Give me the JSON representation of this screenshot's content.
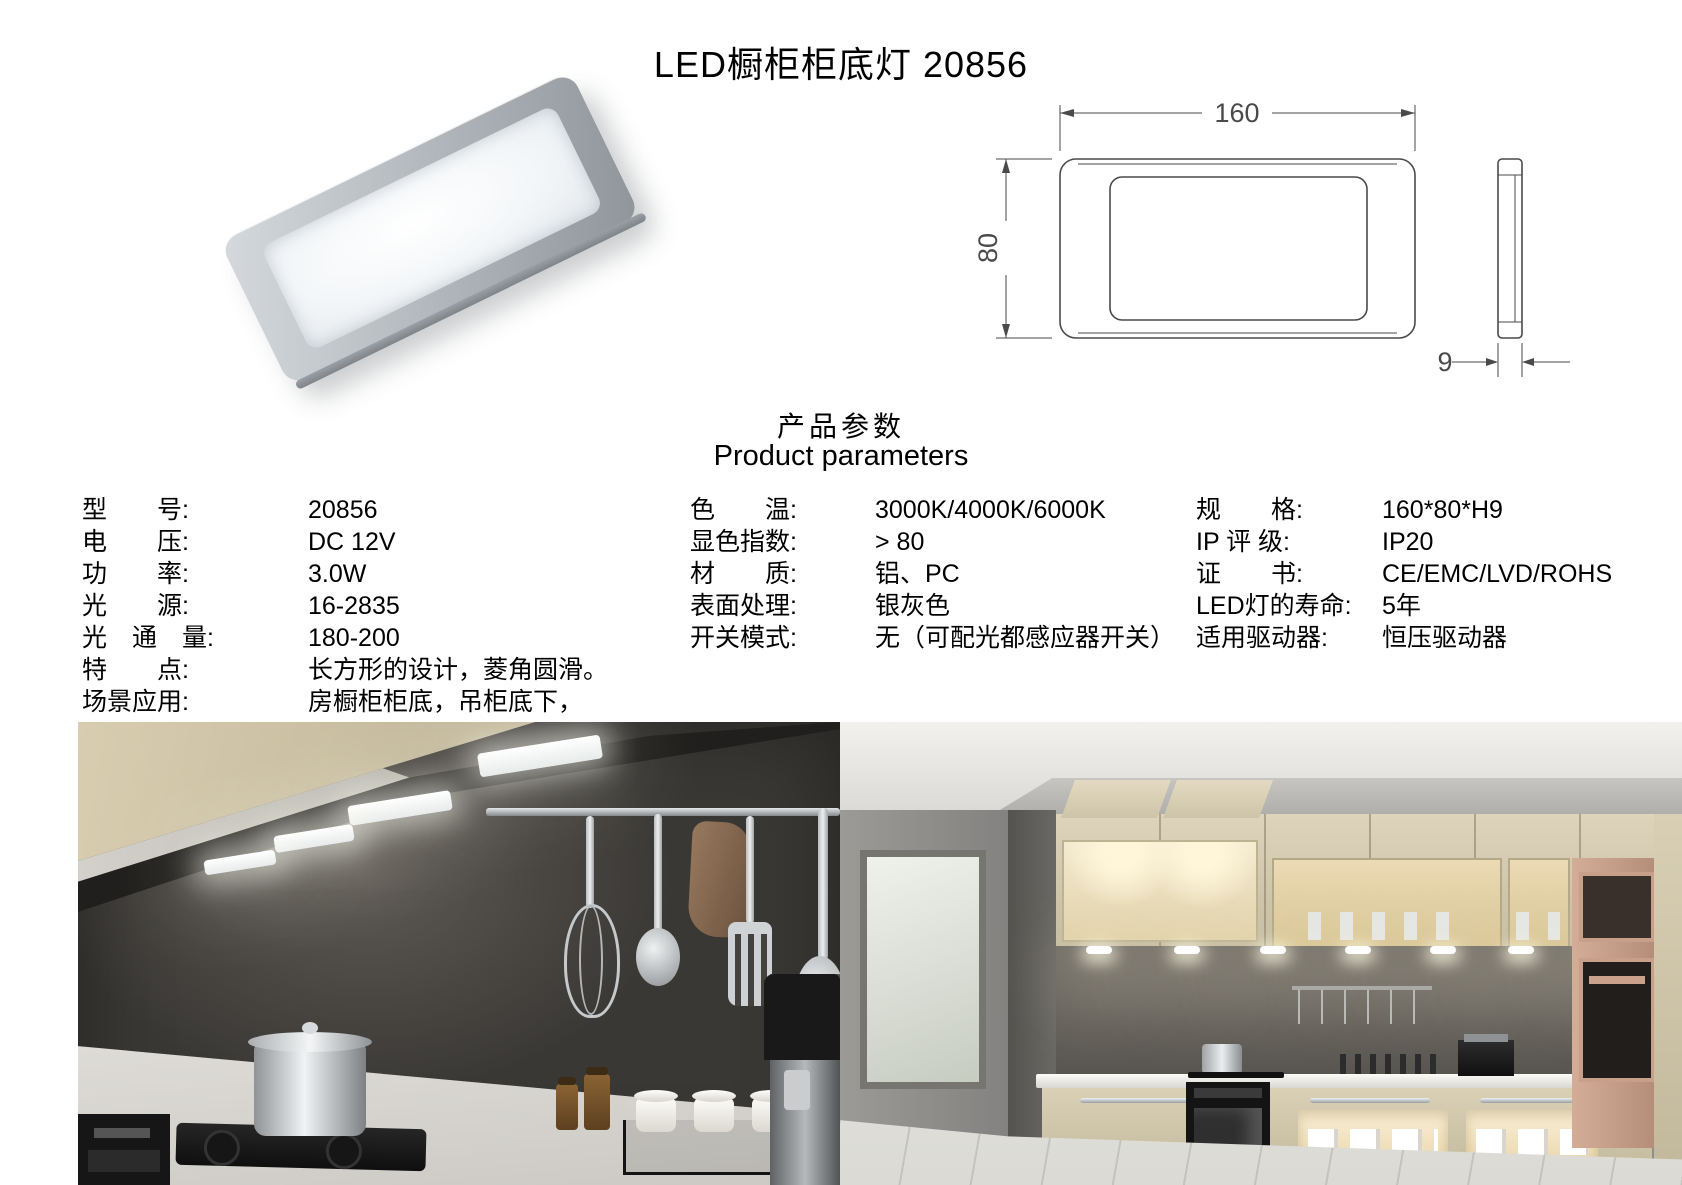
{
  "title": "LED橱柜柜底灯 20856",
  "headings": {
    "zh": "产品参数",
    "en": "Product parameters"
  },
  "drawing": {
    "width": "160",
    "height": "80",
    "thickness": "9"
  },
  "specs": {
    "col1": [
      {
        "label": "型　　号:",
        "value": "20856"
      },
      {
        "label": "电　　压:",
        "value": "DC 12V"
      },
      {
        "label": "功　　率:",
        "value": "3.0W"
      },
      {
        "label": "光　　源:",
        "value": "16-2835"
      },
      {
        "label": "光　通　量:",
        "value": "180-200"
      },
      {
        "label": "特　　点:",
        "value": "长方形的设计，菱角圆滑。"
      },
      {
        "label": "场景应用:",
        "value": "房橱柜柜底，吊柜底下，"
      }
    ],
    "col2": [
      {
        "label": "色　　温:",
        "value": "3000K/4000K/6000K"
      },
      {
        "label": "显色指数:",
        "value": "> 80"
      },
      {
        "label": "材　　质:",
        "value": "铝、PC"
      },
      {
        "label": "表面处理:",
        "value": "银灰色"
      },
      {
        "label": "开关模式:",
        "value": "无（可配光都感应器开关）"
      }
    ],
    "col3": [
      {
        "label": "规　　格:",
        "value": "160*80*H9"
      },
      {
        "label": "IP 评 级:",
        "value": "IP20"
      },
      {
        "label": "证　　书:",
        "value": "CE/EMC/LVD/ROHS"
      },
      {
        "label": "LED灯的寿命:",
        "value": "5年"
      },
      {
        "label": "适用驱动器:",
        "value": "恒压驱动器"
      }
    ]
  }
}
